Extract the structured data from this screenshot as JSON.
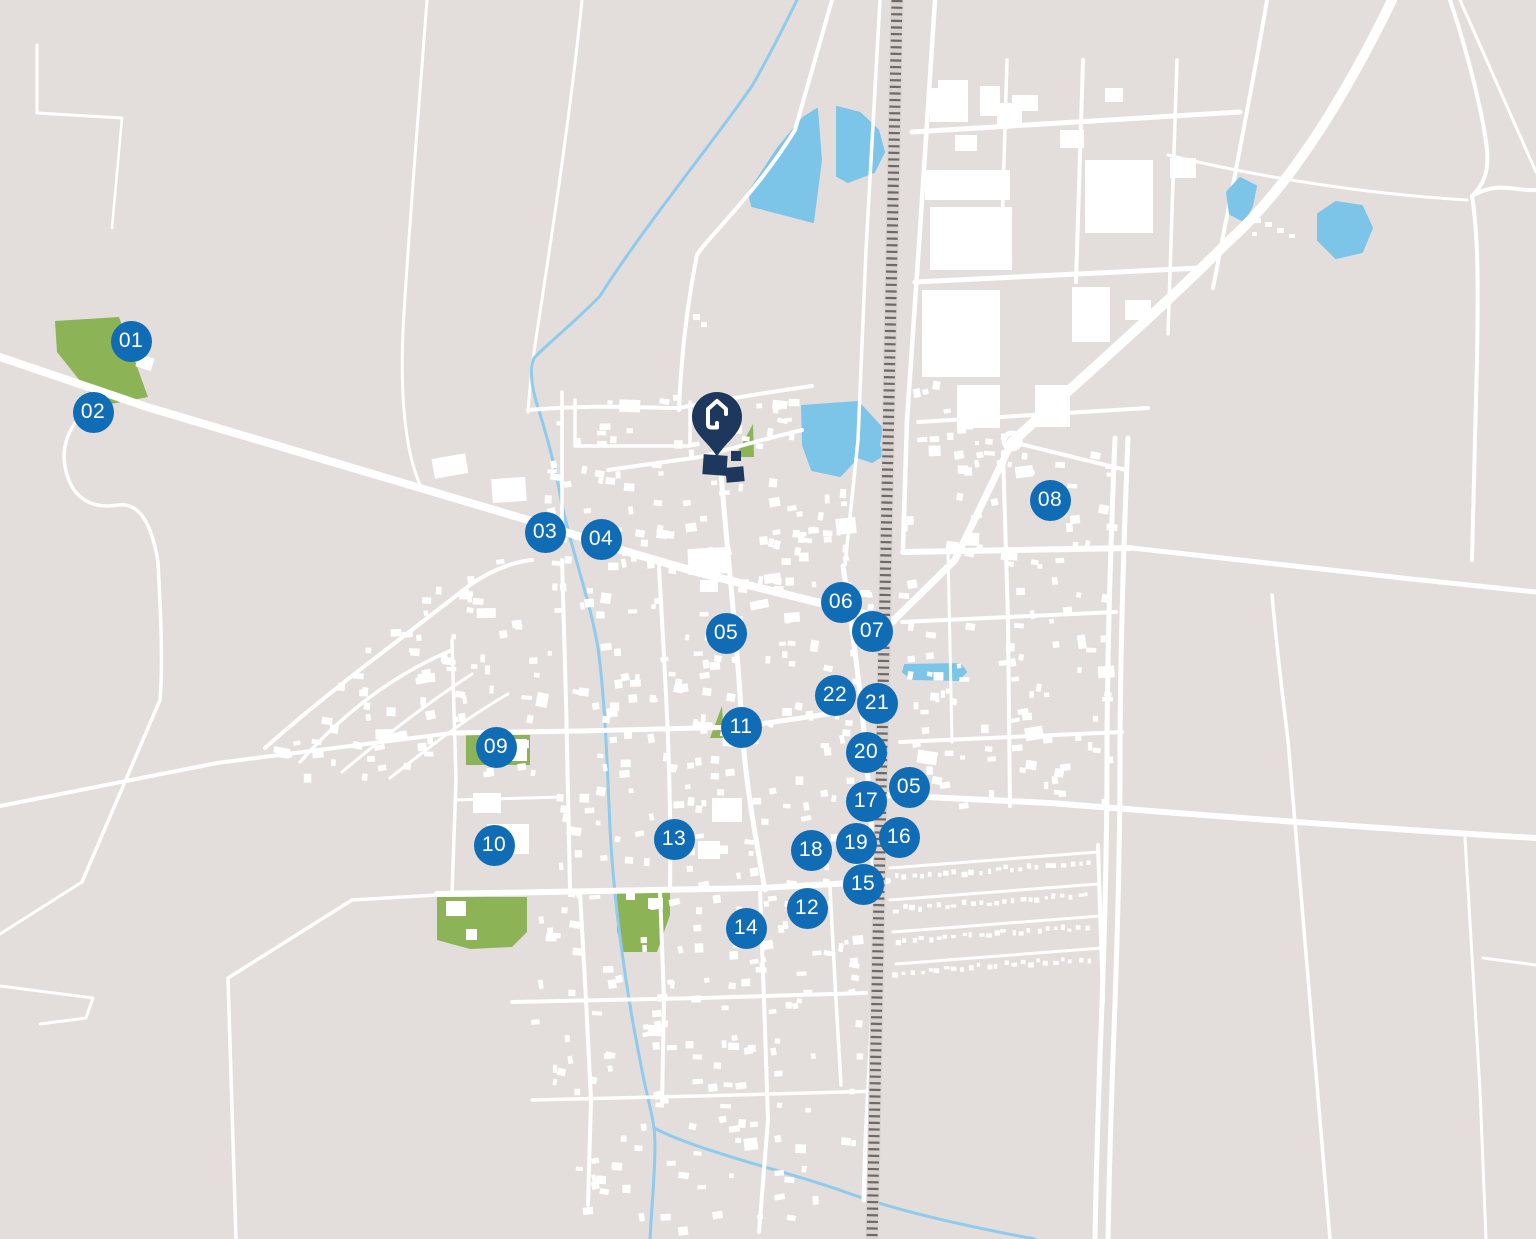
{
  "map": {
    "colors": {
      "background": "#e3dedb",
      "road": "#ffffff",
      "building": "#ffffff",
      "green_area": "#8cb355",
      "water": "#7cc4e8",
      "stream": "#8fcbec",
      "railway_band": "#d8d3d0",
      "railway_ties": "#6f6865",
      "marker": "#106db5",
      "marker_text": "#ffffff",
      "pin": "#1e375c"
    },
    "pin": {
      "x": 717,
      "y": 460,
      "icon": "home-icon"
    },
    "markers": [
      {
        "id": "01",
        "label": "01",
        "x": 131,
        "y": 341
      },
      {
        "id": "02",
        "label": "02",
        "x": 93,
        "y": 412
      },
      {
        "id": "03",
        "label": "03",
        "x": 545,
        "y": 532
      },
      {
        "id": "04",
        "label": "04",
        "x": 601,
        "y": 539
      },
      {
        "id": "05",
        "label": "05",
        "x": 726,
        "y": 633
      },
      {
        "id": "06",
        "label": "06",
        "x": 841,
        "y": 602
      },
      {
        "id": "07",
        "label": "07",
        "x": 872,
        "y": 631
      },
      {
        "id": "08",
        "label": "08",
        "x": 1050,
        "y": 500
      },
      {
        "id": "09",
        "label": "09",
        "x": 496,
        "y": 747
      },
      {
        "id": "10",
        "label": "10",
        "x": 494,
        "y": 845
      },
      {
        "id": "11",
        "label": "11",
        "x": 741,
        "y": 727
      },
      {
        "id": "12",
        "label": "12",
        "x": 807,
        "y": 908
      },
      {
        "id": "13",
        "label": "13",
        "x": 674,
        "y": 839
      },
      {
        "id": "14",
        "label": "14",
        "x": 746,
        "y": 928
      },
      {
        "id": "15",
        "label": "15",
        "x": 863,
        "y": 884
      },
      {
        "id": "16",
        "label": "16",
        "x": 899,
        "y": 837
      },
      {
        "id": "17",
        "label": "17",
        "x": 866,
        "y": 801
      },
      {
        "id": "18",
        "label": "18",
        "x": 811,
        "y": 850
      },
      {
        "id": "19",
        "label": "19",
        "x": 856,
        "y": 843
      },
      {
        "id": "20",
        "label": "20",
        "x": 866,
        "y": 752
      },
      {
        "id": "21",
        "label": "21",
        "x": 877,
        "y": 703
      },
      {
        "id": "22",
        "label": "22",
        "x": 835,
        "y": 695
      },
      {
        "id": "05-east",
        "label": "05",
        "x": 909,
        "y": 787
      }
    ]
  }
}
